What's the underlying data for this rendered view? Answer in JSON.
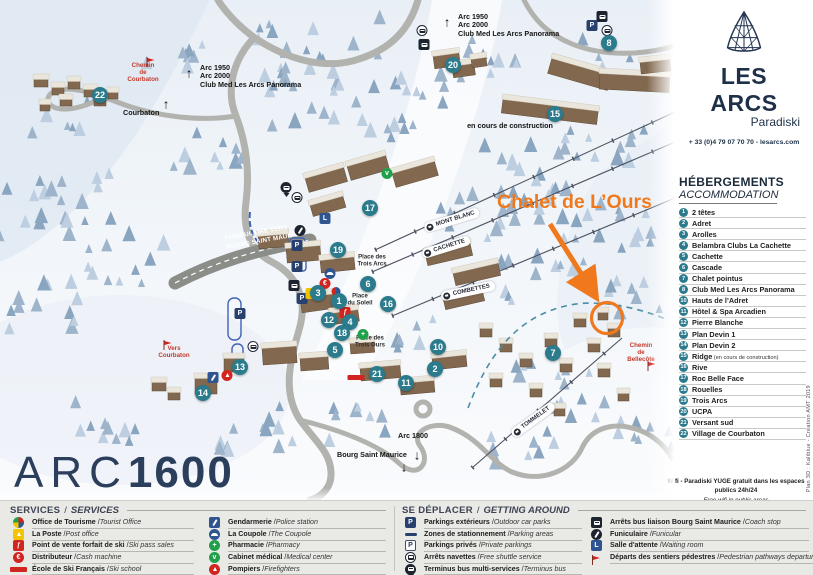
{
  "brand": {
    "name": "LES ARCS",
    "sub": "Paradiski",
    "contact": "+ 33 (0)4 79 07 70 70 - lesarcs.com"
  },
  "map": {
    "resort": {
      "prefix": "ARC",
      "number": "1600"
    },
    "annotation": {
      "label": "Chalet de L’Ours",
      "color": "#f0791d"
    },
    "construction_note": "en cours de construction",
    "funicular_route_label": "FUNICULAIRE VERS\nBOURG SAINT MAURICE",
    "lift_labels": [
      {
        "text": "MONT BLANC",
        "x": 452,
        "y": 220,
        "rot": -17
      },
      {
        "text": "CACHETTE",
        "x": 446,
        "y": 247,
        "rot": -17
      },
      {
        "text": "COMBETTES",
        "x": 468,
        "y": 291,
        "rot": -12
      },
      {
        "text": "TOMMELET",
        "x": 533,
        "y": 420,
        "rot": -36
      }
    ],
    "place_labels": [
      {
        "text": "Place des\nTrois Arcs",
        "x": 372,
        "y": 261
      },
      {
        "text": "Place\ndu Soleil",
        "x": 360,
        "y": 300
      },
      {
        "text": "Place des\nTrois Ours",
        "x": 370,
        "y": 342
      }
    ],
    "red_labels": [
      {
        "text": "Chemin\nde\nCourbaton",
        "x": 143,
        "y": 62
      },
      {
        "text": "Vers\nCourbaton",
        "x": 174,
        "y": 345
      },
      {
        "text": "Chemin\nde\nBellecôte",
        "x": 641,
        "y": 342
      }
    ],
    "direction_labels": [
      {
        "lines": [
          "Arc 1950",
          "Arc 2000",
          "Club Med Les Arcs Panorama"
        ],
        "x": 200,
        "y": 64,
        "arrow": "up",
        "ax": 189,
        "ay": 73
      },
      {
        "lines": [
          "Arc 1950",
          "Arc 2000",
          "Club Med Les Arcs Panorama"
        ],
        "x": 458,
        "y": 13,
        "arrow": "up",
        "ax": 447,
        "ay": 22
      },
      {
        "lines": [
          "Courbaton"
        ],
        "x": 123,
        "y": 109,
        "arrow": "up",
        "ax": 166,
        "ay": 104
      },
      {
        "lines": [
          "Arc 1800"
        ],
        "x": 398,
        "y": 432,
        "arrow": "down",
        "ax": 417,
        "ay": 455
      },
      {
        "lines": [
          "Bourg Saint Maurice"
        ],
        "x": 337,
        "y": 451,
        "arrow": "down",
        "ax": 404,
        "ay": 467
      }
    ],
    "markers": [
      {
        "n": "1",
        "x": 339,
        "y": 301
      },
      {
        "n": "2",
        "x": 435,
        "y": 369
      },
      {
        "n": "3",
        "x": 318,
        "y": 293
      },
      {
        "n": "4",
        "x": 350,
        "y": 322
      },
      {
        "n": "5",
        "x": 335,
        "y": 350
      },
      {
        "n": "6",
        "x": 368,
        "y": 284
      },
      {
        "n": "7",
        "x": 553,
        "y": 353
      },
      {
        "n": "8",
        "x": 609,
        "y": 43
      },
      {
        "n": "10",
        "x": 438,
        "y": 347
      },
      {
        "n": "11",
        "x": 406,
        "y": 383
      },
      {
        "n": "12",
        "x": 329,
        "y": 320
      },
      {
        "n": "13",
        "x": 240,
        "y": 367
      },
      {
        "n": "14",
        "x": 203,
        "y": 393
      },
      {
        "n": "15",
        "x": 555,
        "y": 114
      },
      {
        "n": "16",
        "x": 388,
        "y": 304
      },
      {
        "n": "17",
        "x": 370,
        "y": 208
      },
      {
        "n": "18",
        "x": 342,
        "y": 333
      },
      {
        "n": "19",
        "x": 338,
        "y": 250
      },
      {
        "n": "20",
        "x": 453,
        "y": 65
      },
      {
        "n": "21",
        "x": 377,
        "y": 374
      },
      {
        "n": "22",
        "x": 100,
        "y": 95
      }
    ],
    "icons": [
      {
        "type": "parking",
        "x": 592,
        "y": 23
      },
      {
        "type": "coach",
        "x": 602,
        "y": 15
      },
      {
        "type": "navette",
        "x": 607,
        "y": 29
      },
      {
        "type": "navette",
        "x": 422,
        "y": 29
      },
      {
        "type": "coach",
        "x": 424,
        "y": 43
      },
      {
        "type": "terminus",
        "x": 286,
        "y": 186
      },
      {
        "type": "navette",
        "x": 297,
        "y": 196
      },
      {
        "type": "waiting",
        "x": 325,
        "y": 216
      },
      {
        "type": "funiculaire",
        "x": 300,
        "y": 230
      },
      {
        "type": "parking",
        "x": 297,
        "y": 243
      },
      {
        "type": "parking",
        "x": 297,
        "y": 264
      },
      {
        "type": "coach",
        "x": 294,
        "y": 284
      },
      {
        "type": "parking",
        "x": 302,
        "y": 296
      },
      {
        "type": "parking",
        "x": 240,
        "y": 311
      },
      {
        "type": "poste",
        "x": 311,
        "y": 291
      },
      {
        "type": "distributeur",
        "x": 325,
        "y": 281
      },
      {
        "type": "esfpin",
        "x": 336,
        "y": 292
      },
      {
        "type": "coupole",
        "x": 330,
        "y": 271
      },
      {
        "type": "skipass",
        "x": 345,
        "y": 310
      },
      {
        "type": "esf",
        "x": 356,
        "y": 376
      },
      {
        "type": "pharmacie",
        "x": 363,
        "y": 332
      },
      {
        "type": "medical",
        "x": 387,
        "y": 171
      },
      {
        "type": "gendarmerie",
        "x": 213,
        "y": 377
      },
      {
        "type": "pompiers",
        "x": 227,
        "y": 373
      },
      {
        "type": "navette",
        "x": 253,
        "y": 345
      },
      {
        "type": "flag",
        "x": 151,
        "y": 58
      },
      {
        "type": "flag",
        "x": 168,
        "y": 341
      },
      {
        "type": "flag",
        "x": 652,
        "y": 362
      }
    ]
  },
  "sidebar": {
    "heading_fr": "HÉBERGEMENTS",
    "heading_en": "ACCOMMODATION",
    "items": [
      {
        "num": "1",
        "name": "2 têtes"
      },
      {
        "num": "2",
        "name": "Adret"
      },
      {
        "num": "3",
        "name": "Arolles"
      },
      {
        "num": "4",
        "name": "Belambra Clubs La Cachette"
      },
      {
        "num": "5",
        "name": "Cachette"
      },
      {
        "num": "6",
        "name": "Cascade"
      },
      {
        "num": "7",
        "name": "Chalet pointus"
      },
      {
        "num": "8",
        "name": "Club Med Les Arcs Panorama"
      },
      {
        "num": "10",
        "name": "Hauts de l’Adret"
      },
      {
        "num": "11",
        "name": "Hôtel & Spa Arcadien"
      },
      {
        "num": "12",
        "name": "Pierre Blanche"
      },
      {
        "num": "13",
        "name": "Plan Devin 1"
      },
      {
        "num": "14",
        "name": "Plan Devin 2"
      },
      {
        "num": "15",
        "name": "Ridge",
        "note": "(en cours de construction)"
      },
      {
        "num": "16",
        "name": "Rive"
      },
      {
        "num": "17",
        "name": "Roc Belle Face"
      },
      {
        "num": "18",
        "name": "Rouelles"
      },
      {
        "num": "19",
        "name": "Trois Arcs"
      },
      {
        "num": "20",
        "name": "UCPA"
      },
      {
        "num": "21",
        "name": "Versant sud"
      },
      {
        "num": "22",
        "name": "Village de Courbaton"
      }
    ],
    "credit": "Plan 3D : Kaliblue - Création AMT 2019",
    "wifi_fr": "Wifi - Paradiski YUGE gratuit dans les espaces publics 24h/24",
    "wifi_en": "Free wifi in public areas"
  },
  "legend": {
    "services": {
      "title_fr": "SERVICES",
      "title_en": "SERVICES",
      "col1": [
        {
          "icon": "tourisme",
          "fr": "Office de Tourisme",
          "en": "Tourist Office"
        },
        {
          "icon": "poste",
          "fr": "La Poste",
          "en": "Post office"
        },
        {
          "icon": "skipass",
          "fr": "Point de vente forfait de ski",
          "en": "Ski pass sales"
        },
        {
          "icon": "distributeur",
          "fr": "Distributeur",
          "en": "Cash machine"
        },
        {
          "icon": "esf",
          "fr": "École de Ski Français",
          "en": "Ski school"
        }
      ],
      "col2": [
        {
          "icon": "gendarmerie",
          "fr": "Gendarmerie",
          "en": "Police station"
        },
        {
          "icon": "coupole",
          "fr": "La Coupole",
          "en": "The Coupole"
        },
        {
          "icon": "pharmacie",
          "fr": "Pharmacie",
          "en": "Pharmacy"
        },
        {
          "icon": "medical",
          "fr": "Cabinet médical",
          "en": "Medical center"
        },
        {
          "icon": "pompiers",
          "fr": "Pompiers",
          "en": "Firefighters"
        }
      ]
    },
    "getting_around": {
      "title_fr": "SE DÉPLACER",
      "title_en": "GETTING AROUND",
      "col1": [
        {
          "icon": "parking",
          "fr": "Parkings extérieurs",
          "en": "Outdoor car parks"
        },
        {
          "icon": "dash",
          "fr": "Zones de stationnement",
          "en": "Parking areas"
        },
        {
          "icon": "parking-outline",
          "fr": "Parkings privés",
          "en": "Private parkings"
        },
        {
          "icon": "navette",
          "fr": "Arrêts navettes",
          "en": "Free shuttle service"
        },
        {
          "icon": "terminus",
          "fr": "Terminus bus multi-services",
          "en": "Terminus bus"
        }
      ],
      "col2": [
        {
          "icon": "coach",
          "fr": "Arrêts bus liaison Bourg Saint Maurice",
          "en": "Coach stop"
        },
        {
          "icon": "funiculaire",
          "fr": "Funiculaire",
          "en": "Funicular"
        },
        {
          "icon": "waiting",
          "fr": "Salle d'attente",
          "en": "Waiting room"
        },
        {
          "icon": "flag",
          "fr": "Départs des sentiers pédestres",
          "en": "Pedestrian pathways departures"
        }
      ]
    }
  },
  "colors": {
    "brand_navy": "#1e3048",
    "marker_teal": "#2b7b8c",
    "accent_orange": "#f0791d",
    "alert_red": "#d2251f",
    "legend_bg": "#e9e9e6"
  }
}
